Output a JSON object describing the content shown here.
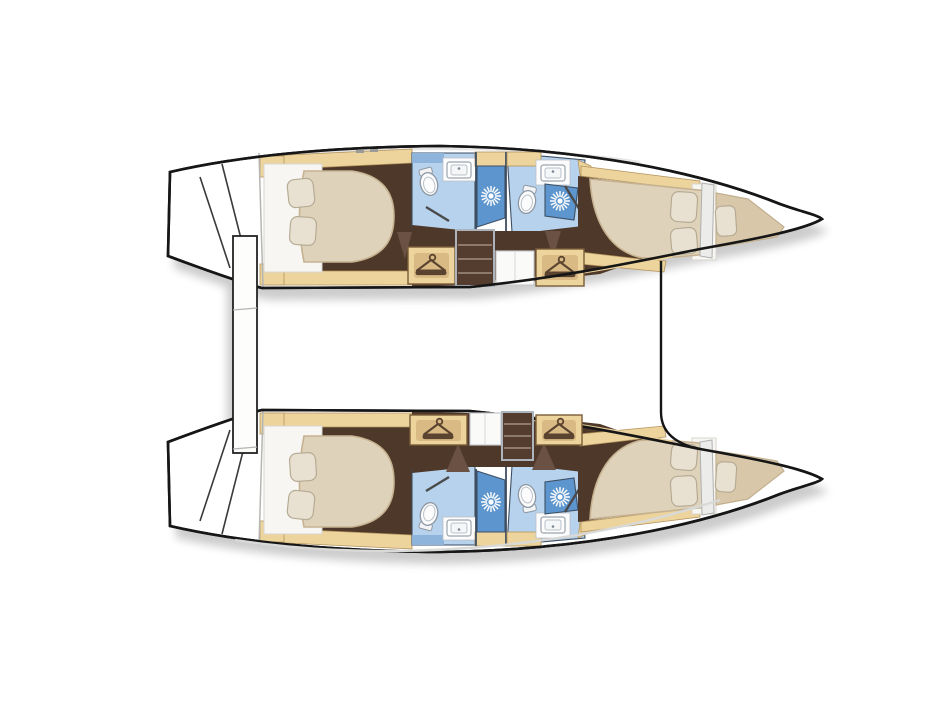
{
  "canvas": {
    "width": 947,
    "height": 710,
    "background": "#ffffff"
  },
  "vessel": {
    "type": "catamaran",
    "view": "overhead lower-deck floor plan",
    "description": "Catamaran yacht lower-deck layout plan, two hulls with four double cabins, four bathrooms with showers, forepeak berths, wardrobes and companionway steps",
    "hull_count": 2,
    "bows_pointing": "right"
  },
  "hulls": [
    {
      "id": "upper-hull",
      "rooms": [
        "aft double cabin",
        "aft bathroom",
        "companionway steps",
        "storage cabinet",
        "forward bathroom",
        "forward double cabin",
        "forepeak berth"
      ],
      "wardrobes": 2
    },
    {
      "id": "lower-hull",
      "rooms": [
        "aft double cabin",
        "aft bathroom",
        "storage cabinet",
        "companionway steps",
        "forward bathroom",
        "forward double cabin",
        "forepeak berth"
      ],
      "wardrobes": 2
    }
  ],
  "fixtures_depicted": {
    "double_beds": 4,
    "forepeak_berths": 2,
    "pillows": 10,
    "toilets": 4,
    "showers": 4,
    "sinks": 4,
    "wardrobes_with_hanger_icon": 4,
    "companionway_step_flights": 2,
    "transom_steps": 2,
    "center_gangway_planks": 1
  },
  "icons": [
    {
      "name": "hanger-icon",
      "meaning": "wardrobe / closet"
    },
    {
      "name": "shower-icon",
      "meaning": "shower head starburst"
    },
    {
      "name": "toilet-icon",
      "meaning": "marine toilet"
    },
    {
      "name": "sink-icon",
      "meaning": "washbasin"
    }
  ],
  "colors": {
    "background": "#ffffff",
    "outline": "#161616",
    "hullFill": "#ffffff",
    "deckShade": "#d9d9d7",
    "wood": "#ecd49c",
    "woodEdge": "#b3925d",
    "woodDark": "#d9ba84",
    "floor": "#4e382a",
    "stepFace": "#543d2e",
    "stepLine": "#8d7a6a",
    "doorBrown": "#6b5143",
    "mattress": "#ded2ba",
    "mattressEdge": "#c6b291",
    "berth": "#d8c8a9",
    "pillow": "#e8e1d2",
    "pillowEdge": "#b7ab94",
    "bedBase": "#f7f6f3",
    "bathLight": "#b7d2ec",
    "bathMid": "#8fb4dc",
    "shower": "#5d95ce",
    "bathWall": "#3e4f63",
    "fixtureWhite": "#fcfcfc",
    "fixtureEdge": "#8e98a4",
    "cabinet": "#fafaf8",
    "grayLine": "#b5b5b3",
    "shadow": "#3a3a3a"
  }
}
